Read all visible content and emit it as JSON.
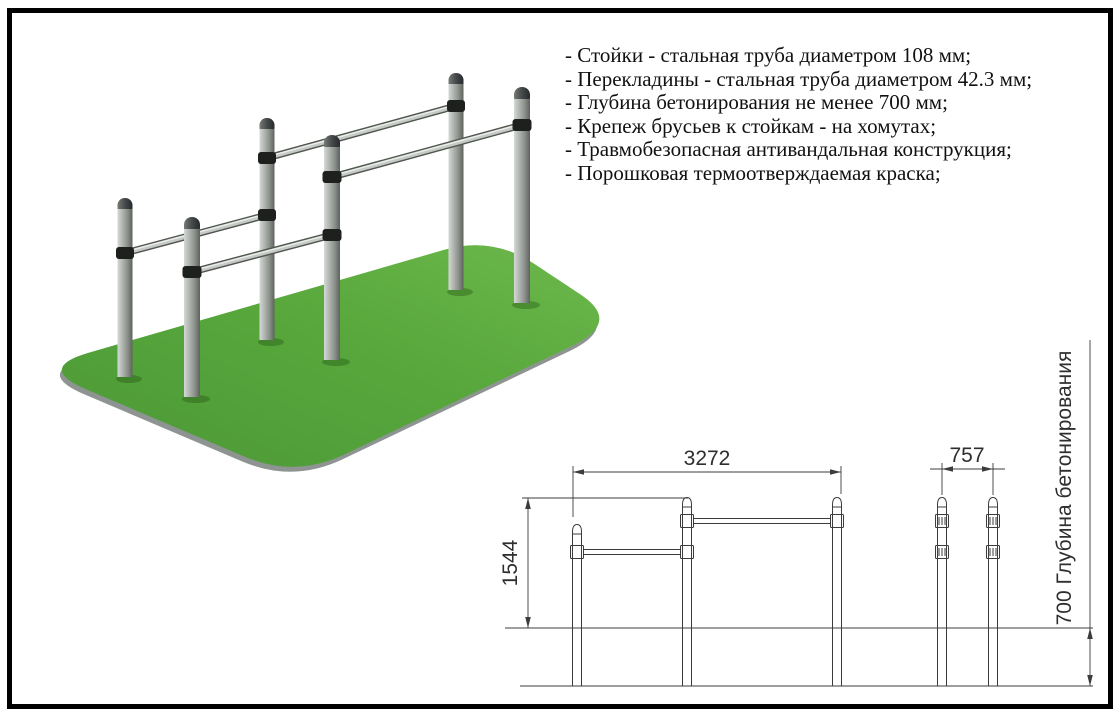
{
  "specs": {
    "items": [
      "- Стойки - стальная труба диаметром 108 мм;",
      "- Перекладины - стальная труба диаметром 42.3 мм;",
      "- Глубина бетонирования не менее 700 мм;",
      "- Крепеж брусьев к стойкам - на хомутах;",
      "- Травмобезопасная антивандальная конструкция;",
      "- Порошковая термоотверждаемая краска;"
    ]
  },
  "drawing": {
    "width_dim": "3272",
    "height_dim": "1544",
    "depth_dim": "757",
    "foundation_dim": "700 Глубина бетонирования"
  },
  "colors": {
    "grass_light": "#85cf4a",
    "grass_mid": "#56aa26",
    "grass_dark": "#3c881b",
    "soil_rim": "#8e9492",
    "post_light": "#d6d9d6",
    "post_dark": "#5d625d",
    "clamp": "#1d201d",
    "drawing_line": "#3c3c3c",
    "frame": "#000000",
    "background": "#ffffff"
  }
}
